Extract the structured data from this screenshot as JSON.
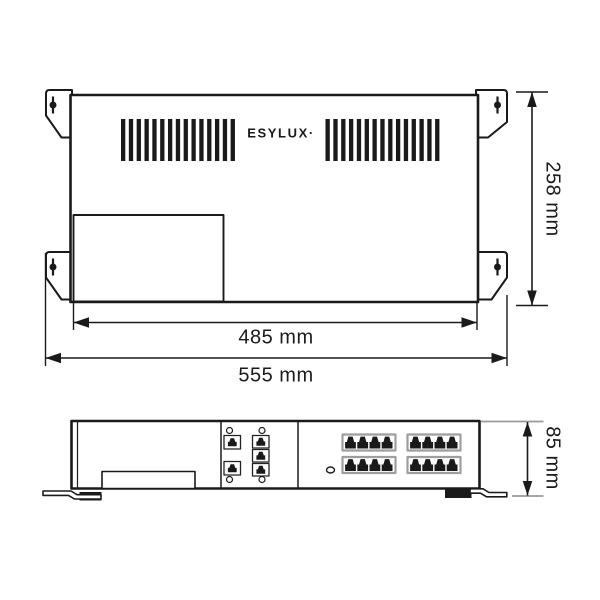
{
  "drawing": {
    "brand_logo": "ESYLUX·",
    "dimensions": {
      "body_width": "485 mm",
      "overall_width": "555 mm",
      "depth": "258 mm",
      "height": "85 mm"
    },
    "top_view": {
      "mounting_brackets": 4,
      "keyhole_slots": 4,
      "vent_groups": 2,
      "vent_slots_per_group": 15
    },
    "front_view": {
      "rj45_banks": 4,
      "ports_per_bank": 4,
      "aux_ports_left_column": 2,
      "aux_ports_right_column": 3,
      "screw_holes": 4,
      "led_indicators": 1,
      "feet": 2
    },
    "colors": {
      "line": "#1a1a1a",
      "dim_tick_gray": "#9a9a9a",
      "rj45_frame_gray": "#9e9e9e",
      "background": "#ffffff"
    }
  }
}
